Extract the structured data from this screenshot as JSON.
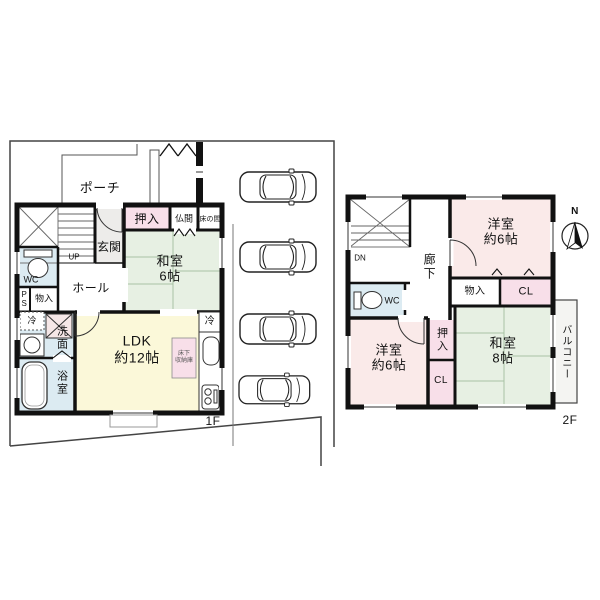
{
  "colors": {
    "wall": "#111111",
    "tatami_green": "#e7f0e3",
    "bedroom_pink": "#faeae9",
    "closet_pink": "#f8dfe9",
    "ldk_yellow": "#fbf8d9",
    "wet_blue": "#dcebf2",
    "entry_gray": "#edecea"
  },
  "floor1": {
    "floor_label": "1F",
    "porch": "ポーチ",
    "closet": "押入",
    "butsuma": "仏間",
    "tokonoma": "床の間",
    "entrance": "玄関",
    "stairs_up": "UP",
    "wc": "WC",
    "pipe_space": "PS",
    "storage": "物入",
    "hall": "ホール",
    "washitsu": "和室\n6帖",
    "fridge_left": "冷",
    "fridge_kitchen": "冷",
    "washroom": "洗面",
    "bathroom": "浴室",
    "ldk": "LDK\n約12帖",
    "underfloor_storage": "床下\n収納庫"
  },
  "floor2": {
    "floor_label": "2F",
    "stairs_down": "DN",
    "corridor": "廊下",
    "wc": "WC",
    "bedroom_ne": "洋室\n約6帖",
    "storage": "物入",
    "closet_top": "CL",
    "bedroom_sw": "洋室\n約6帖",
    "oshiire": "押入",
    "closet_bottom": "CL",
    "washitsu": "和室\n8帖",
    "balcony": "バルコニー",
    "compass_north": "N"
  }
}
